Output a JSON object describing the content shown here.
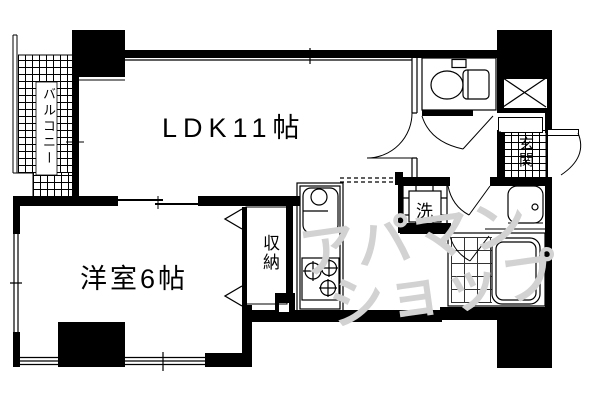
{
  "plan": {
    "colors": {
      "wall": "#000000",
      "background": "#ffffff",
      "watermark": "#d2d2d2"
    },
    "rooms": {
      "ldk": {
        "label": "LDK11帖"
      },
      "western_room": {
        "label": "洋室6帖"
      },
      "balcony": {
        "label": "バルコニー"
      },
      "closet": {
        "label": "収納"
      },
      "entrance": {
        "label": "玄関"
      },
      "laundry": {
        "label": "洗"
      }
    },
    "watermark": {
      "line1": "アパマン",
      "line2": "ショップ"
    }
  }
}
